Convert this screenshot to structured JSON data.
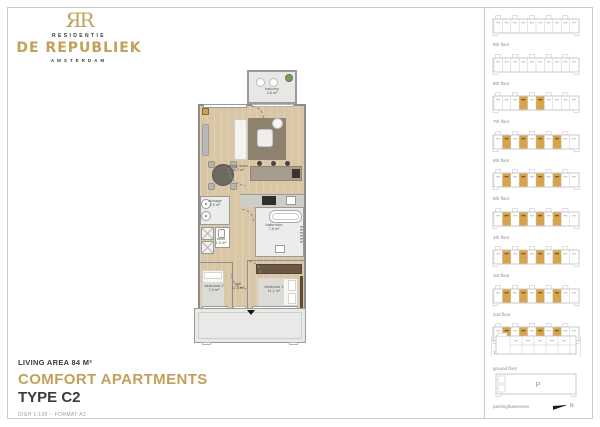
{
  "brand": {
    "monogram": "ЯR",
    "residentie": "RESIDENTIE",
    "name": "DE REPUBLIEK",
    "city": "AMSTERDAM"
  },
  "title_block": {
    "living_area": "LIVING AREA 84 M²",
    "category": "COMFORT APARTMENTS",
    "type": "TYPE C2",
    "meta": "DISH 1:100  –  FORMAT A3"
  },
  "plan": {
    "rooms": [
      {
        "name": "balcony",
        "area": "3,5 m²"
      },
      {
        "name": "living room",
        "area": "38,7 m²"
      },
      {
        "name": "storage",
        "area": "2,5 m²"
      },
      {
        "name": "toilet",
        "area": "1,5 m²"
      },
      {
        "name": "bathroom",
        "area": "7,8 m²"
      },
      {
        "name": "hall",
        "area": "12,5 m²"
      },
      {
        "name": "bedroom 2",
        "area": "7,4 m²"
      },
      {
        "name": "bedroom 1",
        "area": "11,1 m²"
      }
    ]
  },
  "sidebar": {
    "floors": [
      {
        "label": "9th floor",
        "cells": 10,
        "highlighted": []
      },
      {
        "label": "8th floor",
        "cells": 10,
        "highlighted": []
      },
      {
        "label": "7th floor",
        "cells": 10,
        "highlighted": [
          3,
          5
        ]
      },
      {
        "label": "6th floor",
        "cells": 10,
        "highlighted": [
          1,
          3,
          5,
          7
        ]
      },
      {
        "label": "5th floor",
        "cells": 10,
        "highlighted": [
          1,
          3,
          5,
          7
        ]
      },
      {
        "label": "4th floor",
        "cells": 10,
        "highlighted": [
          1,
          3,
          5,
          7
        ]
      },
      {
        "label": "3rd floor",
        "cells": 10,
        "highlighted": [
          1,
          3,
          5,
          7
        ]
      },
      {
        "label": "2nd floor",
        "cells": 10,
        "highlighted": [
          1,
          3,
          5,
          7
        ]
      },
      {
        "label": "1st floor",
        "cells": 10,
        "highlighted": [
          1,
          3,
          5,
          7
        ]
      }
    ],
    "ground": {
      "label": "ground floor"
    },
    "parking": {
      "label": "parking/basement",
      "mark": "P"
    },
    "north": {
      "label": "N"
    }
  },
  "colors": {
    "brand_gold": "#c2a05a",
    "unit_highlight": "#d7a44c",
    "ink": "#3a3a3a"
  }
}
